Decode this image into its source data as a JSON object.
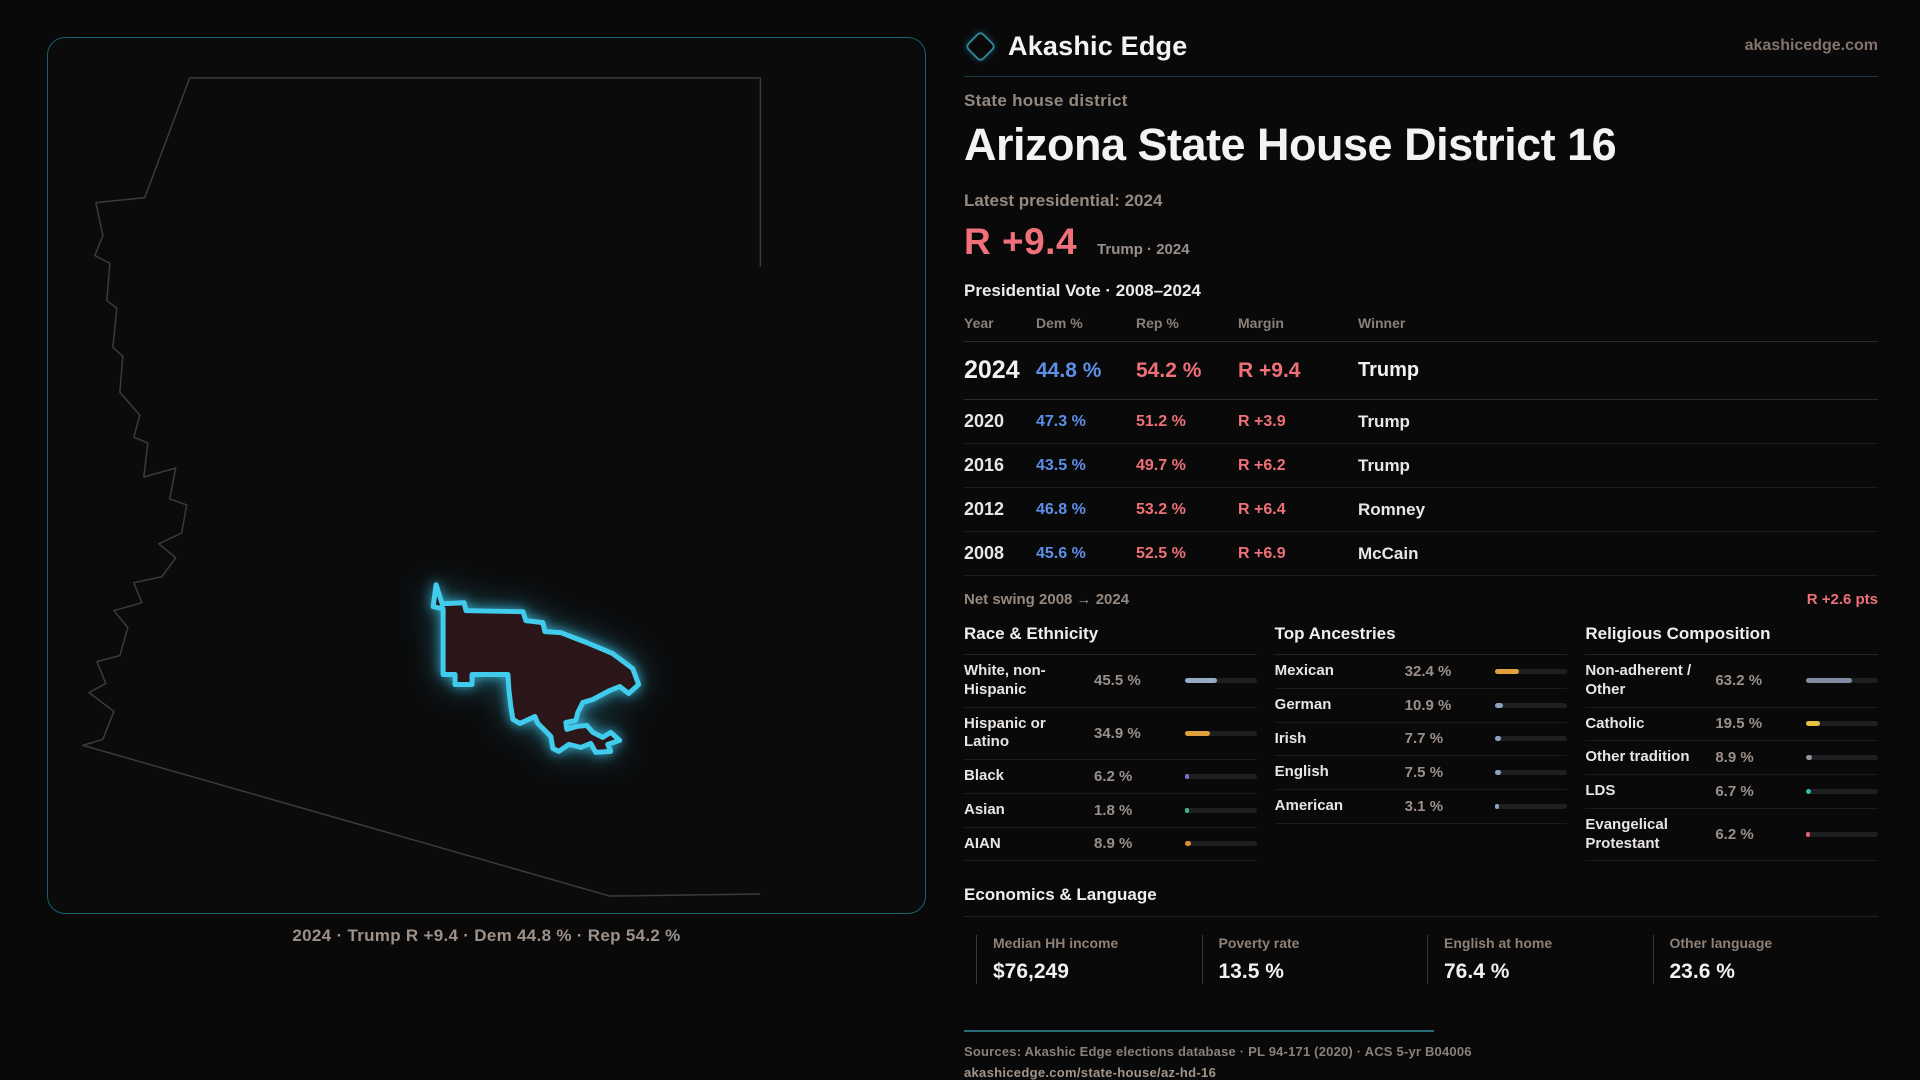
{
  "brand": {
    "name": "Akashic Edge",
    "domain": "akashicedge.com",
    "logo_icon": "diamond-icon"
  },
  "page": {
    "kicker": "State house district",
    "title": "Arizona State House District 16"
  },
  "latest": {
    "label": "Latest presidential: 2024",
    "margin": "R +9.4",
    "note": "Trump · 2024"
  },
  "vote_table": {
    "title": "Presidential Vote · 2008–2024",
    "columns": [
      "Year",
      "Dem %",
      "Rep %",
      "Margin",
      "Winner"
    ],
    "rows": [
      {
        "year": "2024",
        "dem": "44.8 %",
        "rep": "54.2 %",
        "margin": "R +9.4",
        "winner": "Trump",
        "emphasis": true
      },
      {
        "year": "2020",
        "dem": "47.3 %",
        "rep": "51.2 %",
        "margin": "R +3.9",
        "winner": "Trump",
        "emphasis": false
      },
      {
        "year": "2016",
        "dem": "43.5 %",
        "rep": "49.7 %",
        "margin": "R +6.2",
        "winner": "Trump",
        "emphasis": false
      },
      {
        "year": "2012",
        "dem": "46.8 %",
        "rep": "53.2 %",
        "margin": "R +6.4",
        "winner": "Romney",
        "emphasis": false
      },
      {
        "year": "2008",
        "dem": "45.6 %",
        "rep": "52.5 %",
        "margin": "R +6.9",
        "winner": "McCain",
        "emphasis": false
      }
    ]
  },
  "net_swing": {
    "label": "Net swing 2008 → 2024",
    "value": "R +2.6 pts"
  },
  "demographics": [
    {
      "title": "Race & Ethnicity",
      "rows": [
        {
          "label": "White, non-Hispanic",
          "value": "45.5 %",
          "pct": 45.5,
          "color": "#96abc6"
        },
        {
          "label": "Hispanic or Latino",
          "value": "34.9 %",
          "pct": 34.9,
          "color": "#dfa13c"
        },
        {
          "label": "Black",
          "value": "6.2 %",
          "pct": 6.2,
          "color": "#7b6fd2"
        },
        {
          "label": "Asian",
          "value": "1.8 %",
          "pct": 1.8,
          "color": "#3cb886"
        },
        {
          "label": "AIAN",
          "value": "8.9 %",
          "pct": 8.9,
          "color": "#de8f2f"
        }
      ]
    },
    {
      "title": "Top Ancestries",
      "rows": [
        {
          "label": "Mexican",
          "value": "32.4 %",
          "pct": 32.4,
          "color": "#dfa13c"
        },
        {
          "label": "German",
          "value": "10.9 %",
          "pct": 10.9,
          "color": "#8ba3c2"
        },
        {
          "label": "Irish",
          "value": "7.7 %",
          "pct": 7.7,
          "color": "#8ba3c2"
        },
        {
          "label": "English",
          "value": "7.5 %",
          "pct": 7.5,
          "color": "#8ba3c2"
        },
        {
          "label": "American",
          "value": "3.1 %",
          "pct": 3.1,
          "color": "#8ba3c2"
        }
      ]
    },
    {
      "title": "Religious Composition",
      "rows": [
        {
          "label": "Non-adherent / Other",
          "value": "63.2 %",
          "pct": 63.2,
          "color": "#7f8ca2"
        },
        {
          "label": "Catholic",
          "value": "19.5 %",
          "pct": 19.5,
          "color": "#e2c145"
        },
        {
          "label": "Other tradition",
          "value": "8.9 %",
          "pct": 8.9,
          "color": "#8f959c"
        },
        {
          "label": "LDS",
          "value": "6.7 %",
          "pct": 6.7,
          "color": "#2dbfae"
        },
        {
          "label": "Evangelical Protestant",
          "value": "6.2 %",
          "pct": 6.2,
          "color": "#e0636e"
        }
      ]
    }
  ],
  "economics": {
    "title": "Economics & Language",
    "stats": [
      {
        "label": "Median HH income",
        "value": "$76,249"
      },
      {
        "label": "Poverty rate",
        "value": "13.5 %"
      },
      {
        "label": "English at home",
        "value": "76.4 %"
      },
      {
        "label": "Other language",
        "value": "23.6 %"
      }
    ]
  },
  "map": {
    "caption": "2024 · Trump R +9.4 · Dem 44.8 % · Rep 54.2 %",
    "district_fill": "#2b161a",
    "district_stroke": "#41cbec",
    "state_outline_color": "#3b3b3d"
  },
  "footer": {
    "sources": "Sources: Akashic Edge elections database · PL 94-171 (2020) · ACS 5-yr B04006",
    "url": "akashicedge.com/state-house/az-hd-16"
  },
  "colors": {
    "dem_blue": "#5c90e6",
    "rep_red": "#ef7077",
    "accent_teal": "#2e8496"
  }
}
